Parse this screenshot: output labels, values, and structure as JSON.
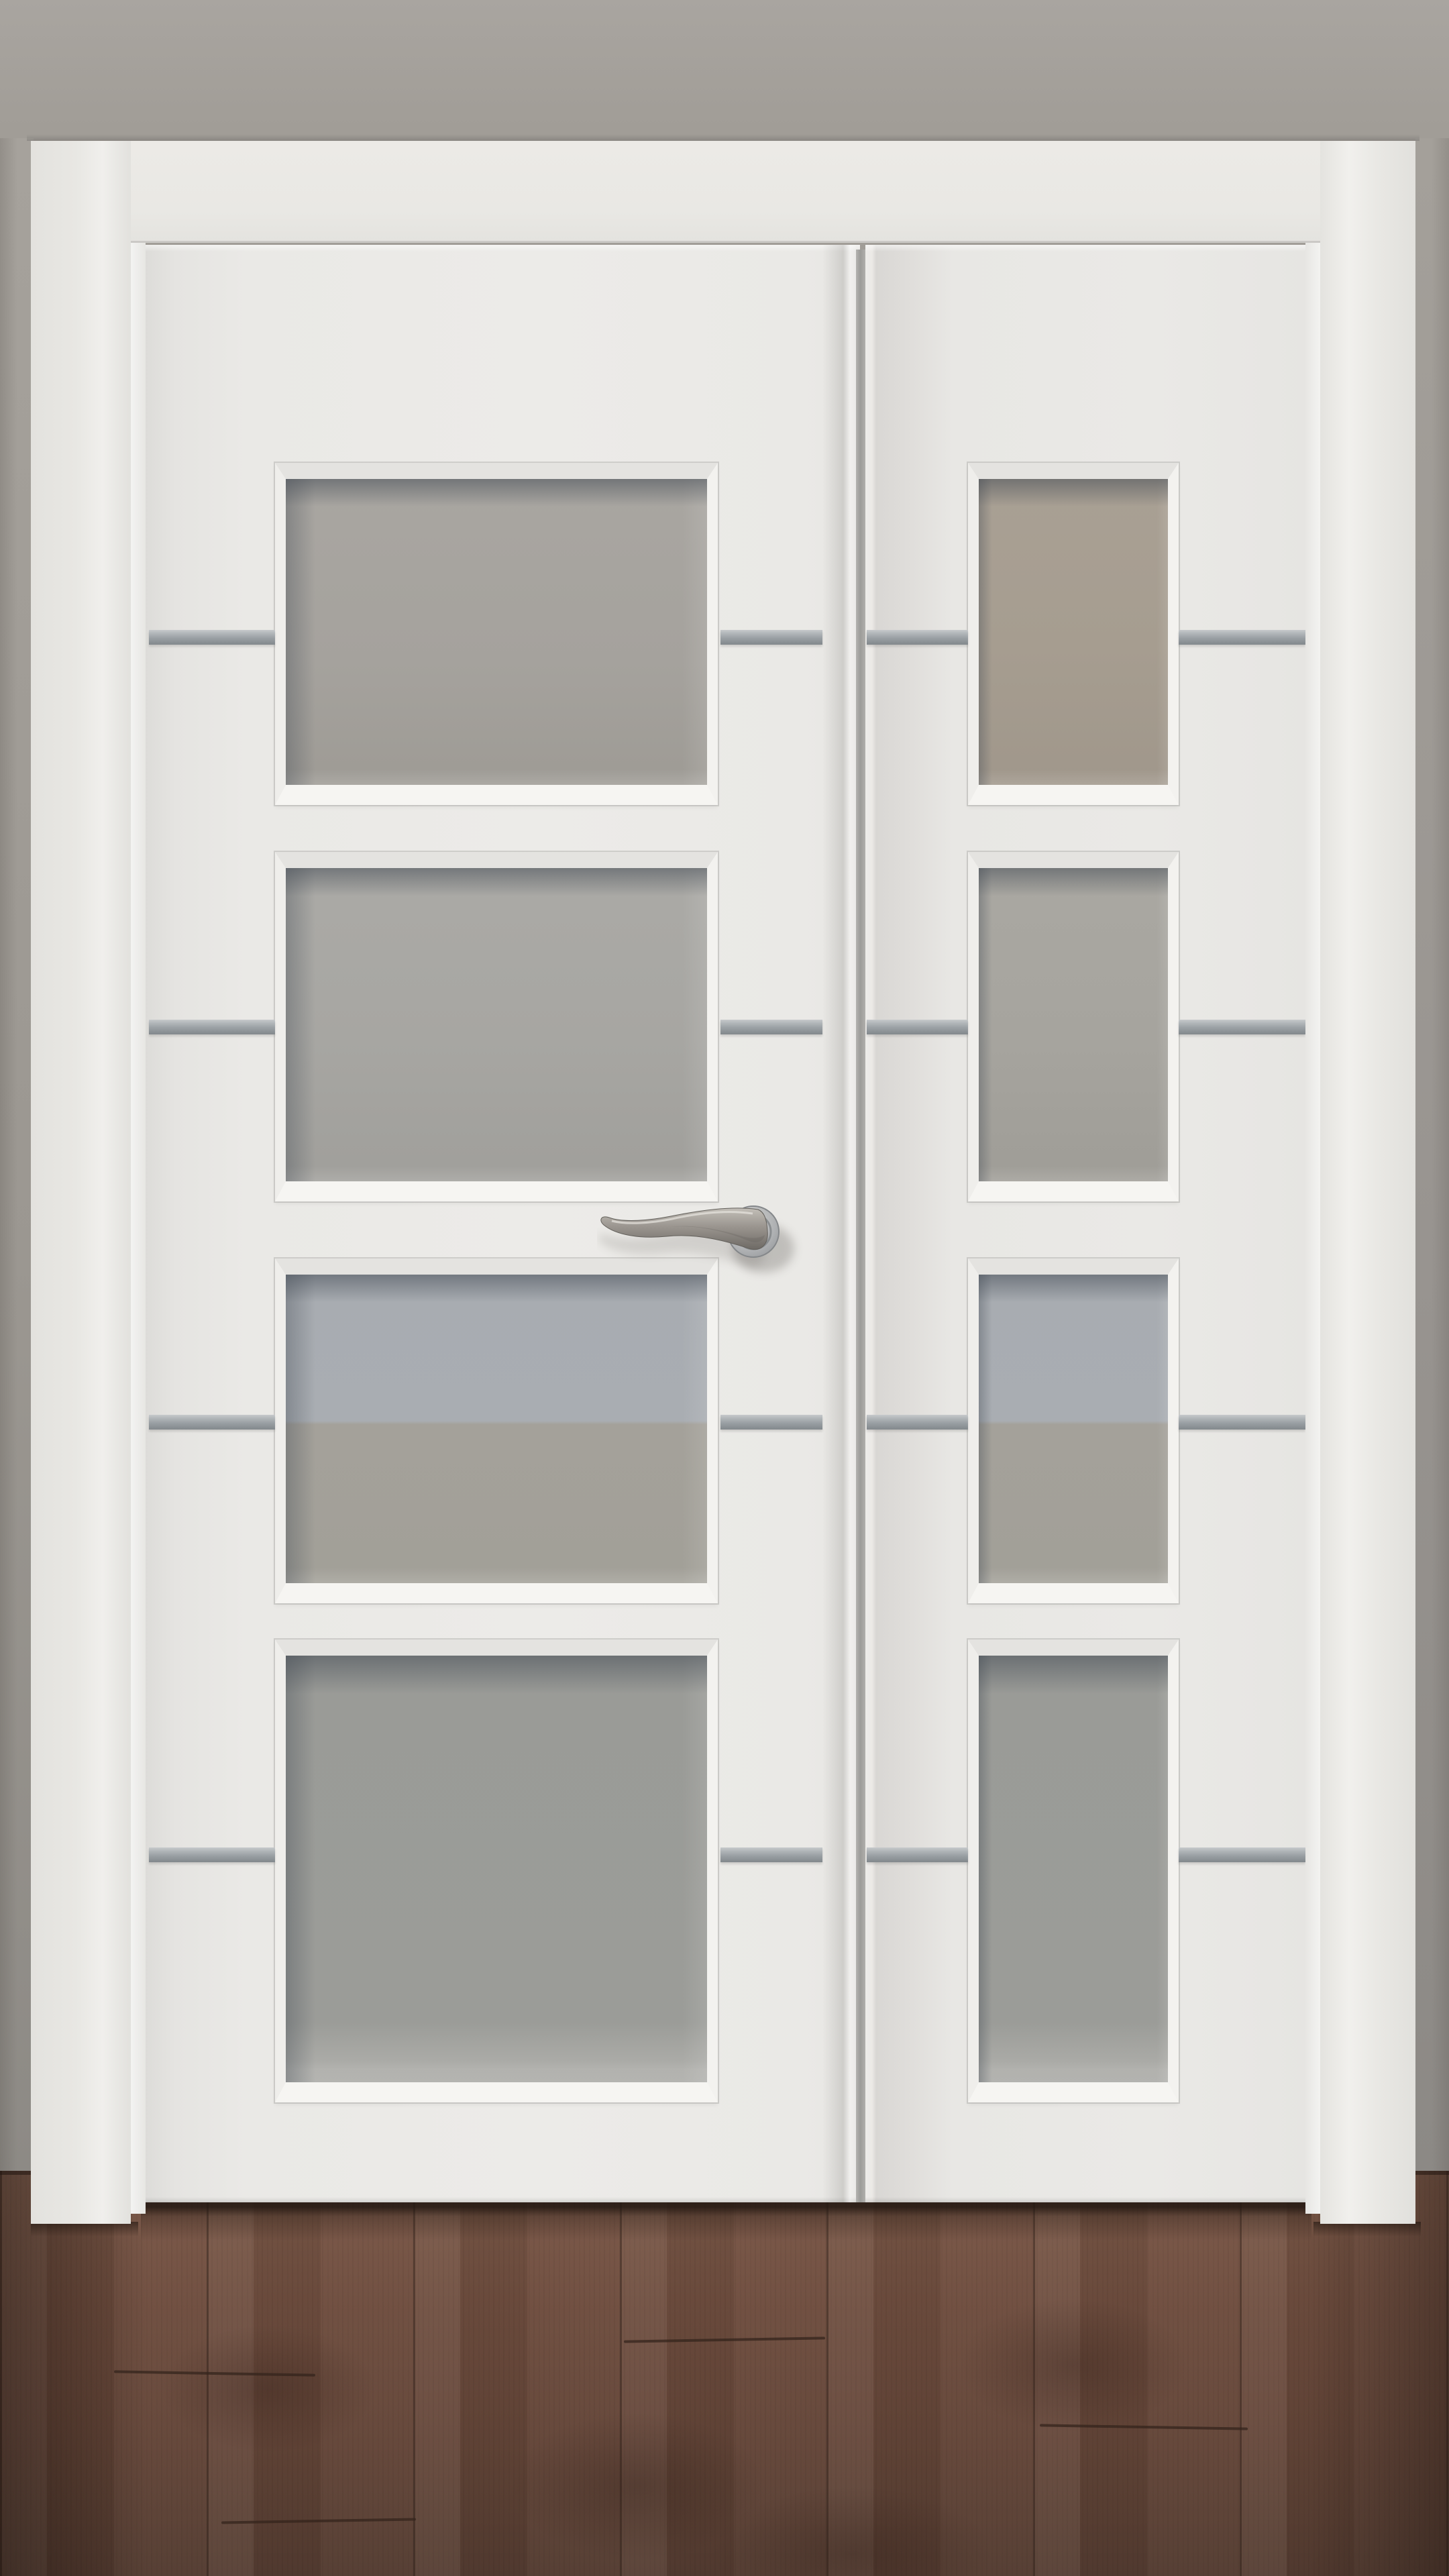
{
  "meta": {
    "description": "Product-style photo of a closed white interior double door with frosted glass panes, aluminium inlay strips and a satin-nickel lever handle, set in a grey wall over a dark walnut wood floor",
    "no_visible_text": true
  },
  "scene": {
    "wall": {
      "label": "grey painted wall"
    },
    "floor": {
      "label": "dark walnut laminate floor",
      "visible_plank_columns": 7
    },
    "door_frame": {
      "label": "white door frame with flat casing",
      "parts": [
        "head casing",
        "left jamb",
        "right jamb"
      ]
    },
    "doors": {
      "left_leaf": {
        "label": "wide active leaf",
        "glass_panels": 4,
        "has_handle": true
      },
      "right_leaf": {
        "label": "narrow semi-fixed leaf",
        "glass_panels": 4,
        "has_handle": false
      }
    },
    "glazing": {
      "type": "frosted glass",
      "panels_total": 8,
      "two_tone_rows": [
        3
      ]
    },
    "inlays": {
      "label": "horizontal aluminium strips",
      "rows": 4,
      "segments_total": 8
    },
    "handle": {
      "label": "twisted lever handle on round rose",
      "finish": "satin nickel"
    }
  },
  "palette": {
    "wall_top": "#a9a5a0",
    "wall_mid": "#a19d97",
    "wall_dark": "#8d8a85",
    "frame_white": "#e9e8e4",
    "reveal": "#f0efec",
    "door_white": "#eae9e6",
    "gap_dark": "#9c9c99",
    "glass_cool": "#a9adb2",
    "glass_warm3": "#a4a19a",
    "glass_gray4": "#9b9c98",
    "glass_tan": "#a69d90",
    "strip_light": "#c6c9cb",
    "strip_mid": "#9aa0a4",
    "strip_dark": "#82888c",
    "floor_light": "#7d5a49",
    "floor_mid": "#6f4e3f",
    "floor_dark": "#543c31",
    "handle_light": "#c3bfb8",
    "handle_mid": "#9a958f",
    "handle_dark": "#6e6a65"
  }
}
